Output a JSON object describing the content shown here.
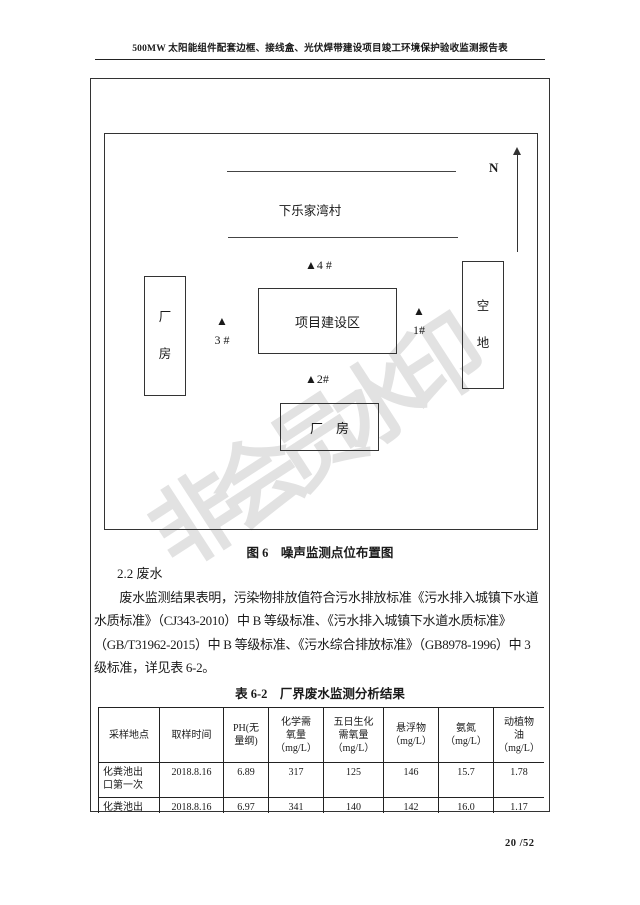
{
  "page": {
    "header_title": "500MW 太阳能组件配套边框、接线盒、光伏焊带建设项目竣工环境保护验收监测报告表",
    "watermark": "非会员水印",
    "page_number": "20 /52"
  },
  "figure": {
    "north_label": "N",
    "village_label": "下乐家湾村",
    "point4_label": "▲4 #",
    "point3_label": "▲\n3 #",
    "point1_label": "▲\n1#",
    "point2_label": "▲2#",
    "left_building_label": "厂\n房",
    "project_area_label": "项目建设区",
    "right_area_label": "空\n地",
    "bottom_building_label": "厂　房",
    "caption": "图 6　噪声监测点位布置图"
  },
  "section": {
    "heading": "2.2 废水",
    "paragraph": "　　废水监测结果表明，污染物排放值符合污水排放标准《污水排入城镇下水道\n水质标准》（CJ343-2010）中 B 等级标准、《污水排入城镇下水道水质标准》\n（GB/T31962-2015）中 B 等级标准、《污水综合排放标准》（GB8978-1996）中 3\n级标准，详见表 6-2。"
  },
  "table": {
    "title": "表 6-2　厂界废水监测分析结果",
    "headers": [
      "采样地点",
      "取样时间",
      "PH(无\n量纲)",
      "化学需\n氧量\n（mg/L）",
      "五日生化\n需氧量\n（mg/L）",
      "悬浮物\n（mg/L）",
      "氨氮\n（mg/L）",
      "动植物\n油\n（mg/L）"
    ],
    "rows": [
      [
        "化粪池出\n口第一次",
        "2018.8.16",
        "6.89",
        "317",
        "125",
        "146",
        "15.7",
        "1.78"
      ],
      [
        "化粪池出",
        "2018.8.16",
        "6.97",
        "341",
        "140",
        "142",
        "16.0",
        "1.17"
      ]
    ]
  }
}
